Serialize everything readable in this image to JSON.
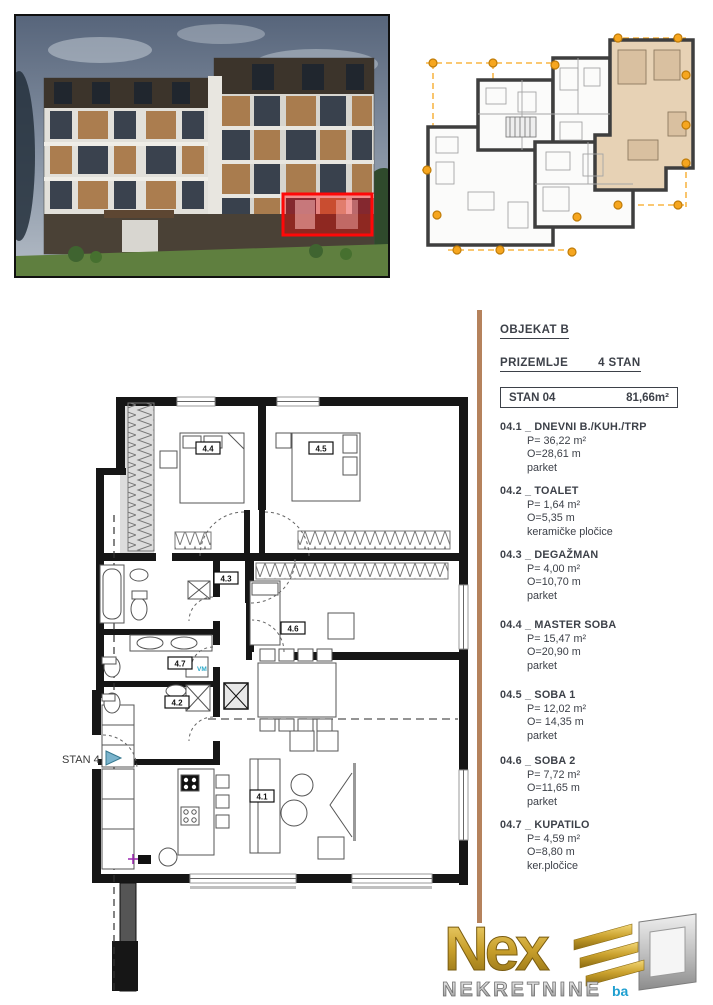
{
  "details_panel": {
    "building_title": "OBJEKAT B",
    "floor_label": "PRIZEMLJE",
    "floor_value": "4 STAN",
    "unit_label": "STAN 04",
    "unit_area": "81,66m²",
    "rooms": [
      {
        "title": "04.1 _ DNEVNI B./KUH./TRP",
        "area": "P= 36,22  m²",
        "perimeter": "O=28,61 m",
        "floor": "parket"
      },
      {
        "title": "04.2 _ TOALET",
        "area": "P= 1,64  m²",
        "perimeter": "O=5,35 m",
        "floor": "keramičke pločice"
      },
      {
        "title": "04.3 _ DEGAŽMAN",
        "area": "P= 4,00  m²",
        "perimeter": "O=10,70 m",
        "floor": "parket"
      },
      {
        "title": "04.4 _ MASTER SOBA",
        "area": "P= 15,47 m²",
        "perimeter": "O=20,90 m",
        "floor": "parket"
      },
      {
        "title": "04.5 _ SOBA 1",
        "area": "P= 12,02  m²",
        "perimeter": "O= 14,35 m",
        "floor": "parket"
      },
      {
        "title": "04.6 _ SOBA 2",
        "area": "P= 7,72 m²",
        "perimeter": "O=11,65 m",
        "floor": "parket"
      },
      {
        "title": "04.7 _ KUPATILO",
        "area": "P= 4,59 m²",
        "perimeter": "O=8,80 m",
        "floor": "ker.pločice"
      }
    ]
  },
  "floor_plan": {
    "stan_label": "STAN 4",
    "labels": {
      "r41": "4.1",
      "r42": "4.2",
      "r43": "4.3",
      "r44": "4.4",
      "r45": "4.5",
      "r46": "4.6",
      "r47": "4.7"
    },
    "vm_label": "VM"
  },
  "render": {
    "highlight_color": "#ff0808"
  },
  "site_plan": {
    "marker_color": "#f6a61f",
    "highlight_fill": "#e7d2b5"
  },
  "logo": {
    "brand": "Nex",
    "subtitle": "NEKRETNINE",
    "domain": "ba"
  }
}
